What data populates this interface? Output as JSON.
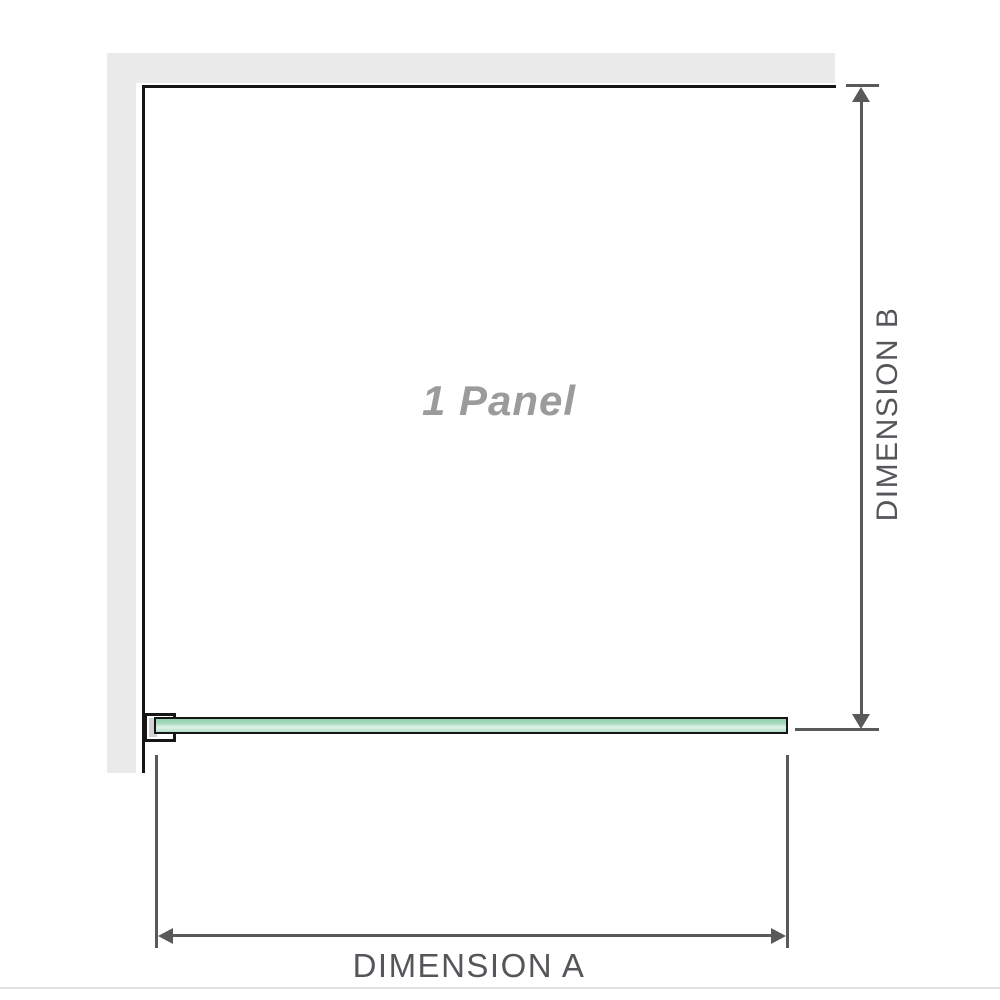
{
  "diagram": {
    "panel_label": "1 Panel",
    "dimension_a": {
      "label": "DIMENSION A"
    },
    "dimension_b": {
      "label": "DIMENSION B"
    },
    "colors": {
      "wall_fill": "#eaeaea",
      "panel_outline": "#161616",
      "dimension_line": "#58595b",
      "dimension_text": "#54565a",
      "panel_label_text": "#9b9b9b",
      "glass_border": "#161616",
      "glass_green": "#a8dabe",
      "glass_highlight": "#ddf2e5",
      "bracket_fill": "#ffffff",
      "bracket_shadow": "#d2d2d2",
      "footer_rule": "#e2e2e2"
    }
  }
}
